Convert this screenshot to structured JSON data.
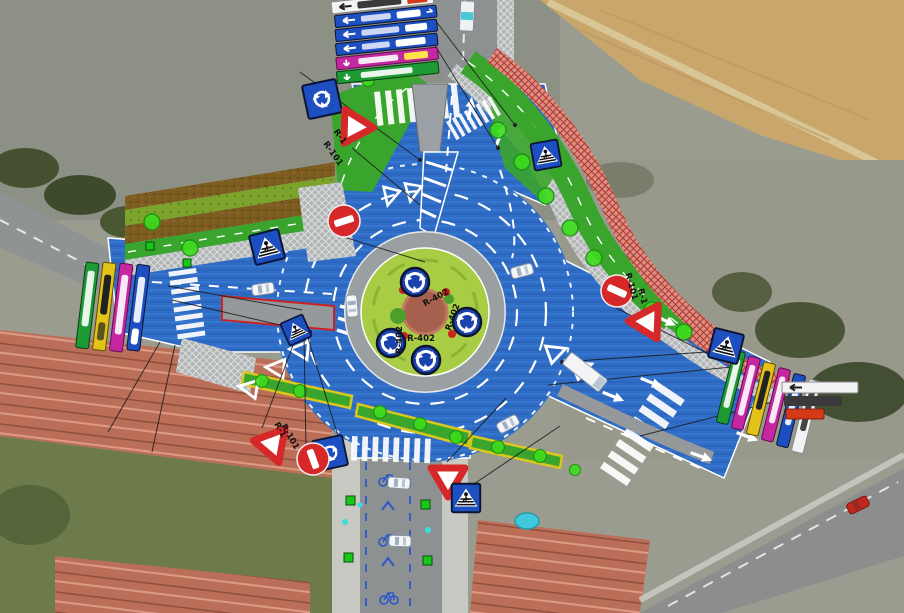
{
  "diagram": {
    "kind": "roundabout-construction-plan-over-aerial-photo",
    "labels": {
      "r402": "R-402",
      "r1": "R-1",
      "r101": "R-101"
    },
    "signs": {
      "regulatory": [
        {
          "code": "R-1",
          "meaning": "yield-triangle"
        },
        {
          "code": "R-101",
          "meaning": "no-entry"
        },
        {
          "code": "R-402",
          "meaning": "roundabout-mandatory"
        }
      ],
      "informative": [
        {
          "name": "pedestrian-crossing-sign"
        },
        {
          "name": "roundabout-ahead-sign"
        },
        {
          "name": "direction-panel-stack"
        }
      ]
    },
    "colors": {
      "painted_asphalt_blue": "#2e6cc6",
      "bike_lane_green": "#3aa52c",
      "island_grass": "#a8cc43",
      "planting_brown": "#7d5c22",
      "future_path_red": "#b23527",
      "sidewalk_gray": "#b3b6b7",
      "sign_blue": "#1d4fc0",
      "sign_magenta": "#c427a0",
      "sign_green": "#1e9a35",
      "sign_yellow": "#e3c219",
      "sign_red": "#d62828",
      "tree_green": "#3ddc1e"
    }
  }
}
